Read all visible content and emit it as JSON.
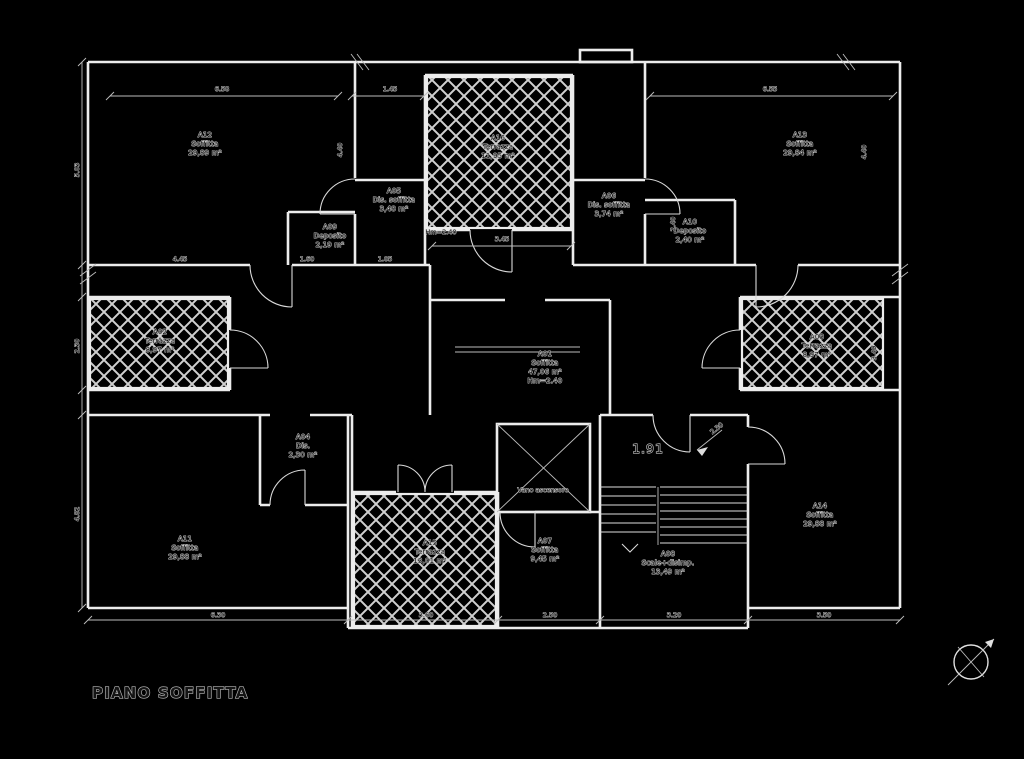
{
  "title": {
    "label": "PIANO SOFFITTA"
  },
  "colors": {
    "background": "#000000",
    "line": "#ececec",
    "hatch": "#cfcfcf",
    "text_halo": "#c6c6c6",
    "text_fill": "#101010"
  },
  "rooms": [
    {
      "code": "A12",
      "name": "Soffitta",
      "area": "29,89 m²"
    },
    {
      "code": "A16",
      "name": "Terrazza",
      "area": "11,95 m²"
    },
    {
      "code": "A13",
      "name": "Soffitta",
      "area": "29,84 m²"
    },
    {
      "code": "A05",
      "name": "Dis. soffitta",
      "area": "3,48 m²"
    },
    {
      "code": "A09",
      "name": "Deposito",
      "area": "2,19 m²"
    },
    {
      "code": "A06",
      "name": "Dis. soffitta",
      "area": "3,74 m²"
    },
    {
      "code": "A10",
      "name": "Deposito",
      "area": "2,40 m²"
    },
    {
      "code": "A02",
      "name": "Terrazza",
      "area": "8,97 m²"
    },
    {
      "code": "A03",
      "name": "Terrazza",
      "area": "8,97 m²"
    },
    {
      "code": "A01",
      "name": "Soffitta",
      "area": "47,06 m²",
      "height": "Hm=2.40"
    },
    {
      "code": "A04",
      "name": "Dis.",
      "area": "2,30 m²"
    },
    {
      "code": "A11",
      "name": "Soffitta",
      "area": "29,88 m²"
    },
    {
      "code": "A15",
      "name": "Terrazza",
      "area": "13,01 m²"
    },
    {
      "code": "A07",
      "name": "Soffitta",
      "area": "9,45 m²"
    },
    {
      "code": "A08",
      "name": "Scale+disimp.",
      "area": "13,49 m²"
    },
    {
      "code": "A14",
      "name": "Soffitta",
      "area": "29,88 m²"
    }
  ],
  "elevator": {
    "label": "Vano ascensore"
  },
  "annotations": {
    "mean_height": "Hm=2.40",
    "stair_width": "1.91",
    "slope_height": "2.30"
  },
  "dims": [
    "6.58",
    "1.45",
    "3.45",
    "6.55",
    "5.03",
    "2.30",
    "4.82",
    "4.40",
    "4.45",
    "1.60",
    "1.05",
    "2.40",
    "6.30",
    "3.60",
    "2.50",
    "3.20",
    "3.50",
    "3.40",
    "4.40"
  ]
}
